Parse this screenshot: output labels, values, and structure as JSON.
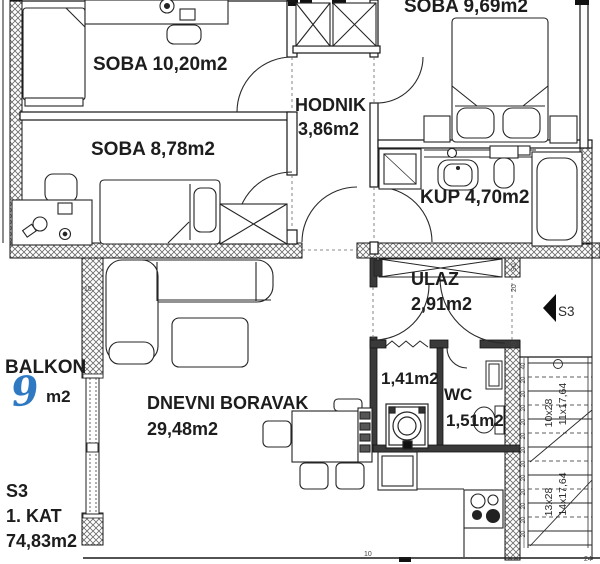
{
  "rooms": [
    {
      "key": "soba1",
      "label": "SOBA 10,20m2"
    },
    {
      "key": "soba3",
      "label": "SOBA 8,78m2"
    },
    {
      "key": "soba2",
      "label": "SOBA 9,69m2"
    },
    {
      "key": "hodnik",
      "name": "HODNIK",
      "area": "3,86m2"
    },
    {
      "key": "kup",
      "label": "KUP 4,70m2"
    },
    {
      "key": "ulaz",
      "name": "ULAZ",
      "area": "2,91m2"
    },
    {
      "key": "dnevni",
      "name": "DNEVNI BORAVAK",
      "area": "29,48m2"
    },
    {
      "key": "util",
      "area": "1,41m2"
    },
    {
      "key": "wc",
      "name": "WC",
      "area": "1,51m2"
    },
    {
      "key": "balkon",
      "name": "BALKON",
      "area_value": "9",
      "area_unit": "m2"
    }
  ],
  "unit_info": {
    "unit": "S3",
    "floor": "1. KAT",
    "total_area": "74,83m2"
  },
  "compass": {
    "label": "S3"
  },
  "stairs": {
    "flight_labels": [
      "10x28",
      "11x17,64",
      "13x28",
      "14x17,64"
    ],
    "step_dims": [
      "40",
      "20",
      "20",
      "20",
      "20",
      "20",
      "20",
      "20",
      "20",
      "20",
      "20",
      "20",
      "20"
    ]
  },
  "dims": {
    "w90": "90",
    "w20": "20",
    "w40": "40",
    "balcony": "15",
    "bottom": "10",
    "corner": "24"
  },
  "colors": {
    "annotation_blue": "#2e79c2",
    "wall_line": "#1a1a1a"
  }
}
